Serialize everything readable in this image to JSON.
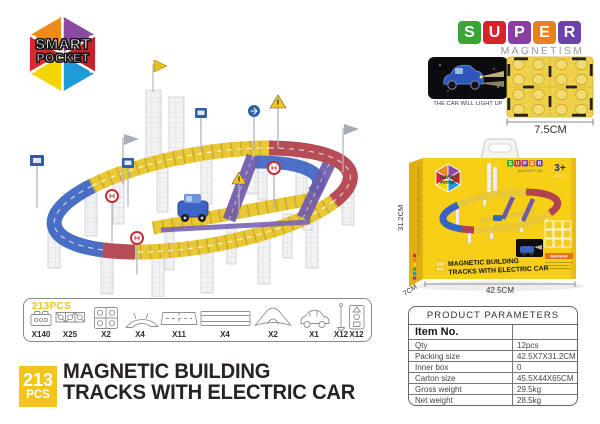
{
  "brand": {
    "line1": "SMART",
    "line2": "POCKET"
  },
  "super_logo": {
    "letters": [
      "S",
      "U",
      "P",
      "E",
      "R"
    ],
    "letter_fills": [
      "#3aa435",
      "#d6242b",
      "#8a3f9e",
      "#e8821e",
      "#6c44a8"
    ],
    "letter_styles": [
      "background:#3aa435",
      "background:#d6242b",
      "background:#8a3f9e",
      "background:#e8821e",
      "background:#6c44a8"
    ],
    "subtitle": "MAGNETISM"
  },
  "car_feature": {
    "caption": "THE CAR WILL LIGHT UP"
  },
  "tile_sample": {
    "size_label": "7.5CM"
  },
  "box": {
    "age_badge": "3+",
    "age_sub": "AGES",
    "pcs_badge_line1": "213",
    "pcs_badge_line2": "PCS",
    "title_line1": "MAGNETIC BUILDING",
    "title_line2": "TRACKS WITH ELECTRIC CAR",
    "warning_label": "WARNING",
    "side_text": "MAGNETIC BUILDING TRACKS WITH ELECTRIC CAR",
    "dim_width": "42.5CM",
    "dim_depth": "7CM",
    "dim_height": "31.2CM"
  },
  "parts_list": {
    "total": "213PCS",
    "items": [
      {
        "name": "base-brick",
        "count": "X140"
      },
      {
        "name": "connector-strip",
        "count": "X25"
      },
      {
        "name": "square-tile",
        "count": "X2"
      },
      {
        "name": "curved-track",
        "count": "X4"
      },
      {
        "name": "short-track",
        "count": "X11"
      },
      {
        "name": "long-track",
        "count": "X4"
      },
      {
        "name": "ramp-junction",
        "count": "X2"
      },
      {
        "name": "electric-car",
        "count": "X1"
      },
      {
        "name": "pole",
        "count": "X12"
      },
      {
        "name": "traffic-signs",
        "count": "X12"
      }
    ]
  },
  "headline": {
    "pcs_number": "213",
    "pcs_label": "PCS",
    "title_line1": "MAGNETIC BUILDING",
    "title_line2": "TRACKS WITH ELECTRIC CAR"
  },
  "parameters_table": {
    "title": "PRODUCT PARAMETERS",
    "rows": [
      {
        "label": "Item No.",
        "value": ""
      },
      {
        "label": "Qty",
        "value": "12pcs"
      },
      {
        "label": "Packing size",
        "value": "42.5X7X31.2CM"
      },
      {
        "label": "Inner box",
        "value": "0"
      },
      {
        "label": "Carton size",
        "value": "45.5X44X65CM"
      },
      {
        "label": "Gross weight",
        "value": "29.5kg"
      },
      {
        "label": "Net weight",
        "value": "28.5kg"
      }
    ]
  },
  "colors": {
    "badge_yellow": "#f2c41c",
    "box_yellow": "#f6cf16",
    "track_yellow": "#e9c735",
    "track_red": "#b2424d",
    "track_blue": "#3a62c0",
    "ramp_purple": "#6f5aa8"
  }
}
